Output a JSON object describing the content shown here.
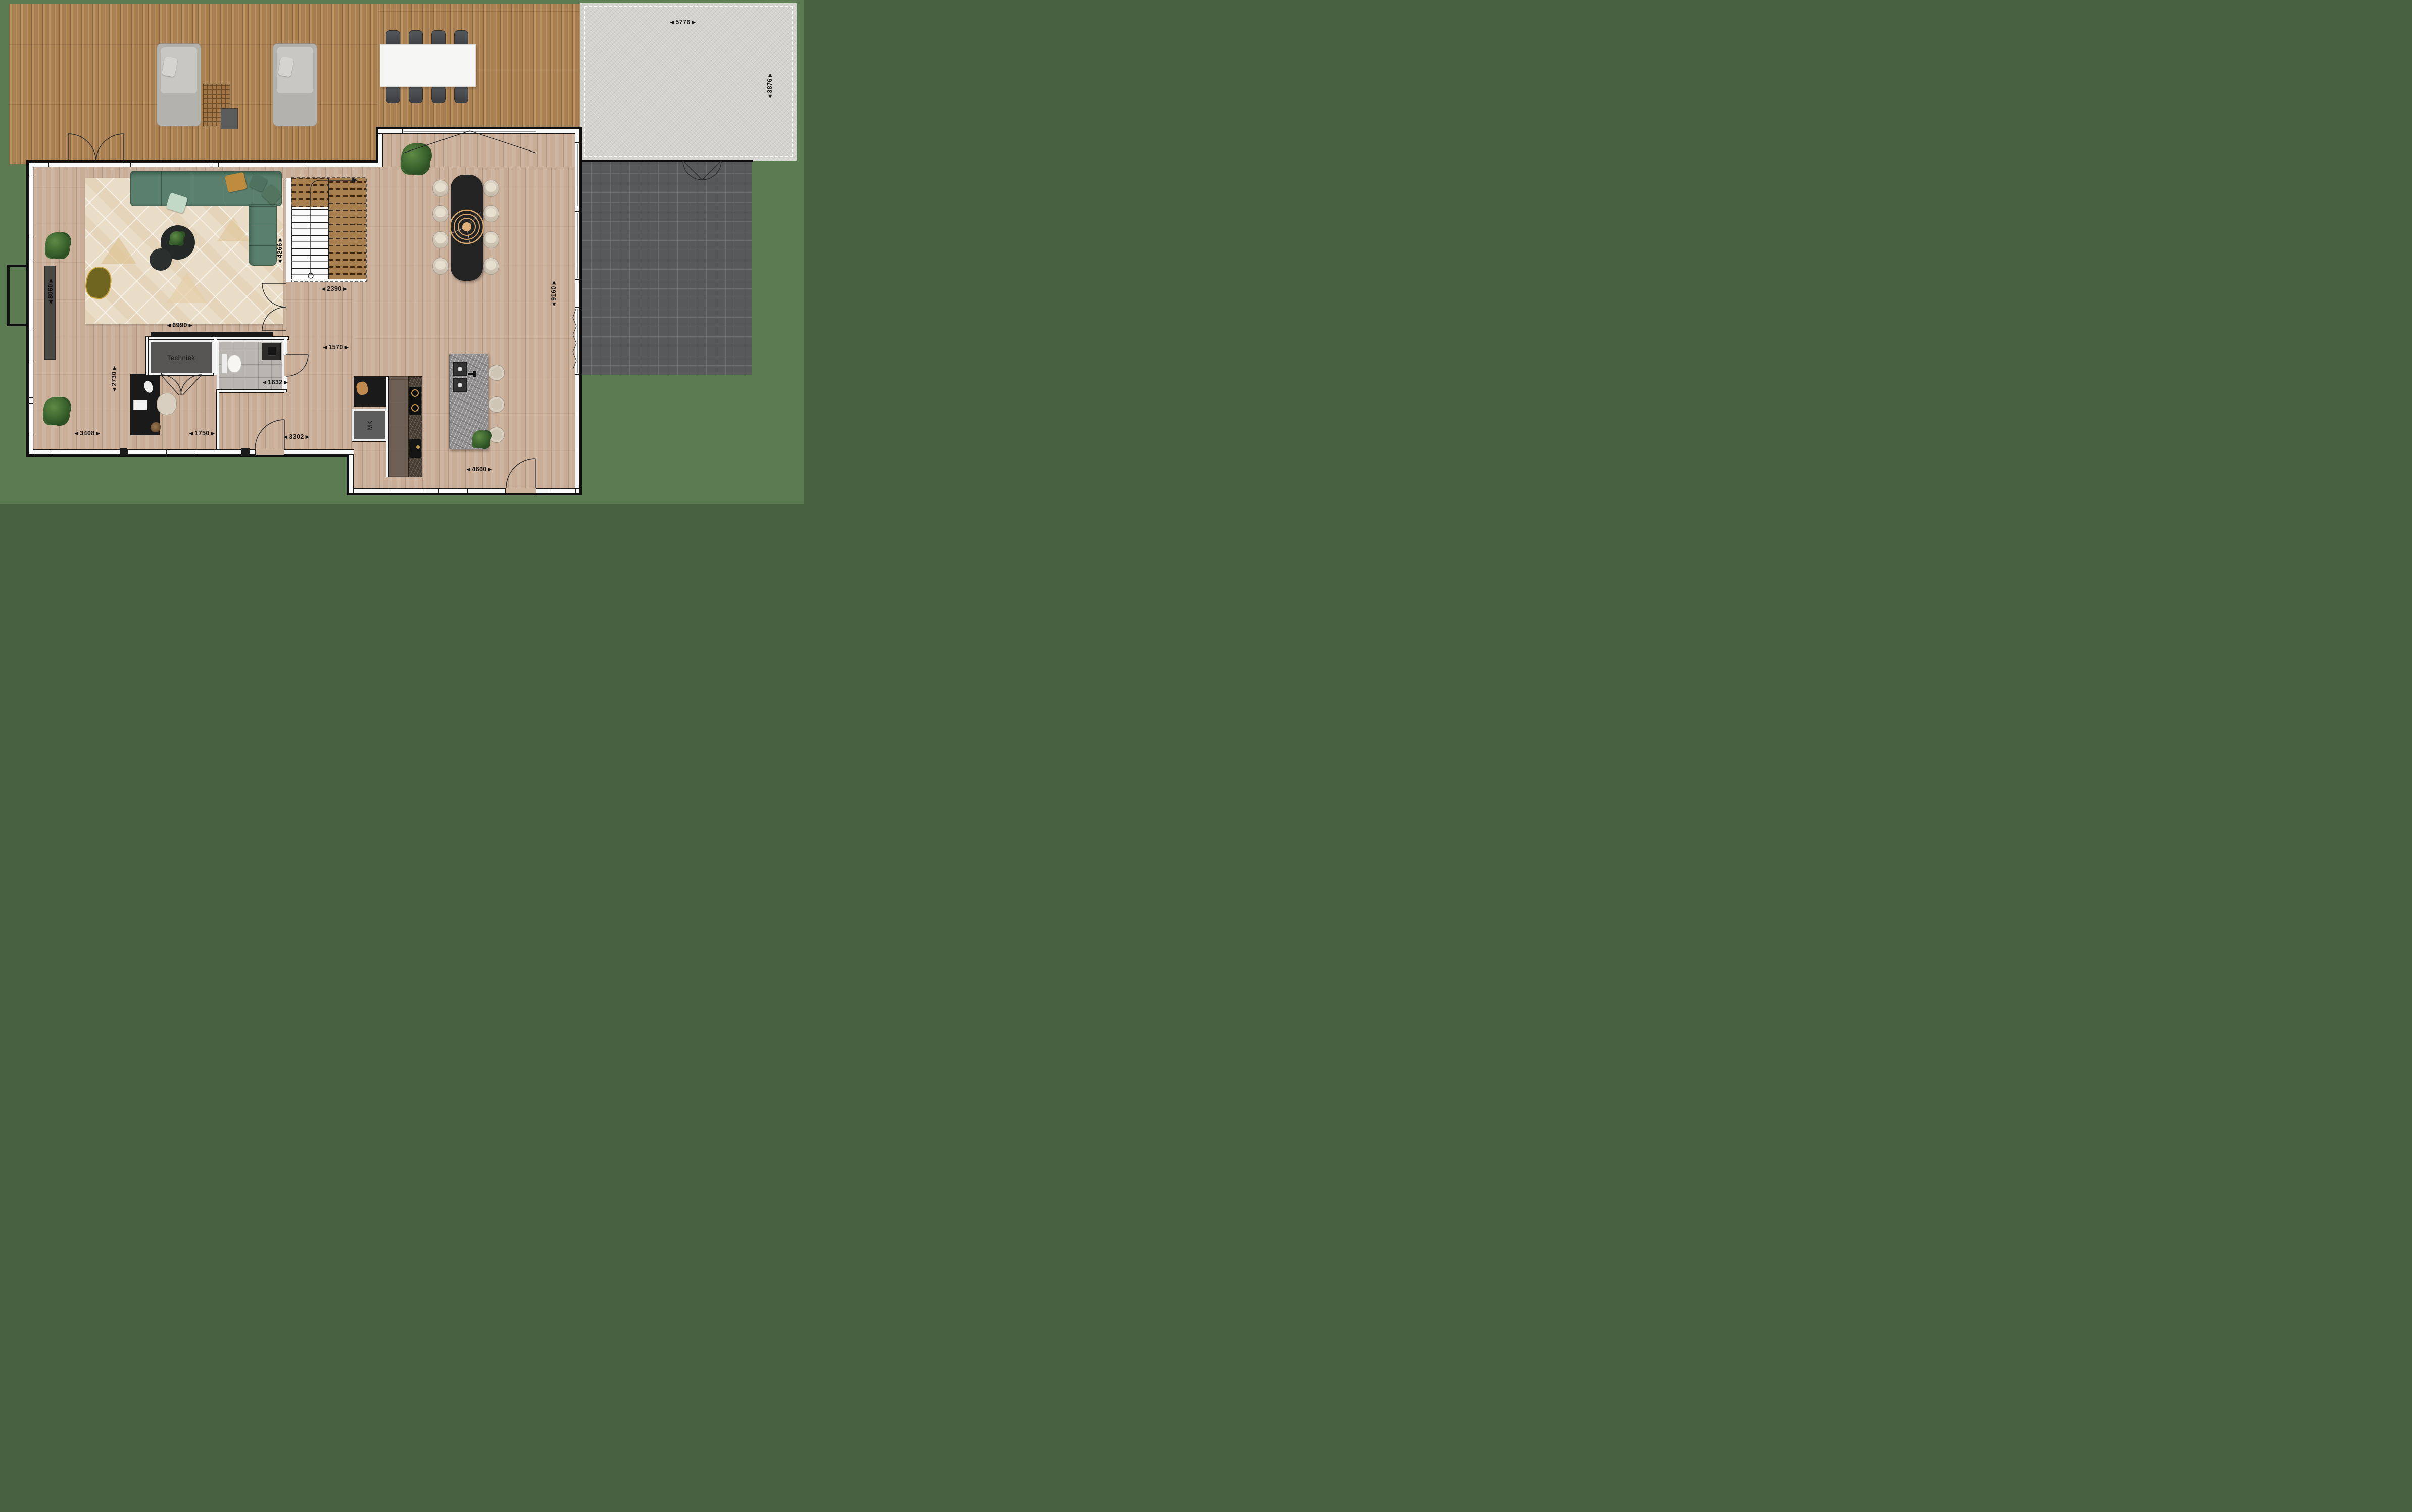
{
  "plan": {
    "rooms": {
      "techniek_label": "Techniek",
      "mk_label": "MK"
    },
    "dimensions": {
      "patio_width": "5776",
      "patio_depth": "3876",
      "living_depth": "8060",
      "stairwell_depth": "4266",
      "stairwell_width": "2390",
      "living_width": "6990",
      "dining_depth": "9160",
      "office_depth": "2730",
      "hallway_width": "1570",
      "toilet_width": "1632",
      "office_width": "3408",
      "entry_width": "1750",
      "hall_depth": "3302",
      "kitchen_width": "4660"
    }
  },
  "icons": {
    "arrow_left": "◀",
    "arrow_right": "▶"
  },
  "colors": {
    "bg_green": "#5d7b52",
    "deck": "#b1875a",
    "floor": "#c9ad97",
    "wall": "#f7f8f8",
    "sofa": "#5a7f6c",
    "rug": "#e9ddc8",
    "table_black": "#232323",
    "pendant_gold": "#d2a268",
    "tile": "#58595a",
    "concrete": "#d4d2ce",
    "island_marble": "#929090",
    "counter_brown": "#6f6055"
  }
}
